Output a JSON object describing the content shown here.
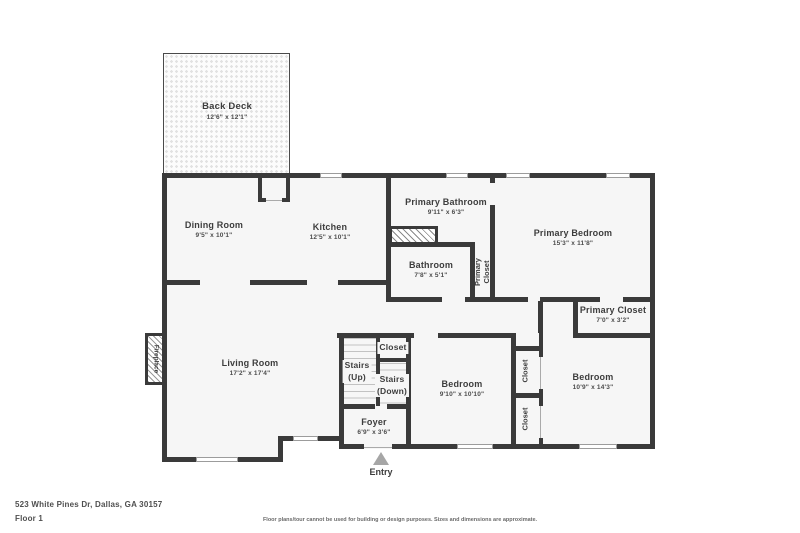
{
  "meta": {
    "address": "523 White Pines Dr, Dallas, GA 30157",
    "floor": "Floor 1",
    "disclaimer": "Floor plans/tour cannot be used for building or design purposes. Sizes and dimensions are approximate.",
    "entry": "Entry"
  },
  "colors": {
    "wall": "#3a3a3a",
    "floor": "#f6f6f6",
    "window_line": "#9c9c9c",
    "entry_arrow": "#a6a6a6"
  },
  "rooms": {
    "back_deck": {
      "name": "Back Deck",
      "dims": "12'6\" x 12'1\""
    },
    "dining": {
      "name": "Dining Room",
      "dims": "9'5\" x 10'1\""
    },
    "kitchen": {
      "name": "Kitchen",
      "dims": "12'5\" x 10'1\""
    },
    "primary_bathroom": {
      "name": "Primary Bathroom",
      "dims": "9'11\" x 6'3\""
    },
    "primary_bedroom": {
      "name": "Primary Bedroom",
      "dims": "15'3\" x 11'8\""
    },
    "bathroom": {
      "name": "Bathroom",
      "dims": "7'8\" x 5'1\""
    },
    "primary_closet_hall": {
      "line1": "Primary",
      "line2": "Closet"
    },
    "primary_closet": {
      "name": "Primary Closet",
      "dims": "7'0\" x 3'2\""
    },
    "living": {
      "name": "Living Room",
      "dims": "17'2\" x 17'4\""
    },
    "fireplace": {
      "name": "Fireplace"
    },
    "stairs_closet": {
      "name": "Closet"
    },
    "stairs_up": {
      "line1": "Stairs",
      "line2": "(Up)"
    },
    "stairs_down": {
      "line1": "Stairs",
      "line2": "(Down)"
    },
    "bedroom_mid": {
      "name": "Bedroom",
      "dims": "9'10\" x 10'10\""
    },
    "closet_upper": {
      "name": "Closet"
    },
    "closet_lower": {
      "name": "Closet"
    },
    "bedroom_right": {
      "name": "Bedroom",
      "dims": "10'9\" x 14'3\""
    },
    "foyer": {
      "name": "Foyer",
      "dims": "6'9\" x 3'6\""
    }
  }
}
